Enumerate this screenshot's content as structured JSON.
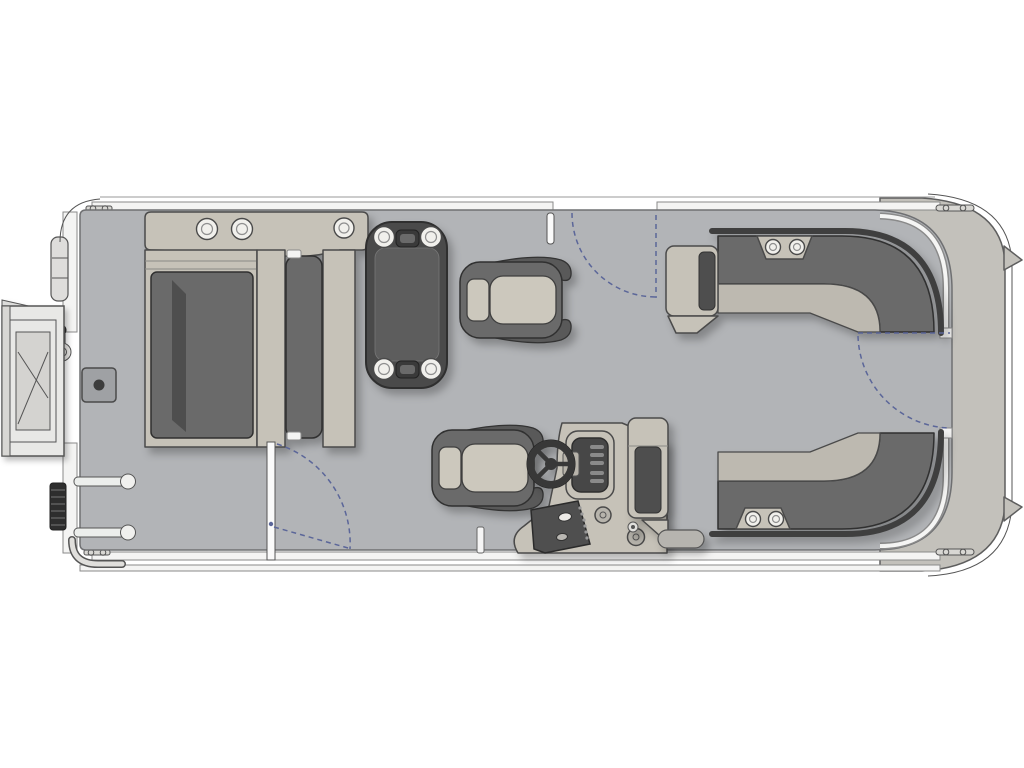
{
  "meta": {
    "title": "Pontoon boat floor plan, top-down view",
    "view": "top-down",
    "orientation": "bow on right, swim deck and boarding gate on left"
  },
  "colors": {
    "background": "#ffffff",
    "deck": "#b2b4b7",
    "hull_band": "#c3c1bb",
    "trim_white": "#f4f4f3",
    "trim_edge": "#8a8a8a",
    "outline": "#4a4a4a",
    "outline_dark": "#303030",
    "furniture_base": "#c6c2b8",
    "bench_seat": "#bdb9b0",
    "cushion": "#6a6a6a",
    "cushion_dark": "#4e4e4e",
    "cushion_darker": "#3f3f3f",
    "seat_light": "#ccc8bd",
    "panel_dark": "#474747",
    "cup_white": "#f1f0ec",
    "hatch": "#9fa1a4",
    "ladder_dark": "#2e2e2e",
    "gate_white": "#fafafa",
    "swing": "#5b6699",
    "shadow": "rgba(0,0,0,0.25)"
  },
  "components": {
    "hull": "pontoon hull with rub rails, cleats and bow platform",
    "port_boarding_gate": "boarding gate shown swung open with step platform",
    "stern_ladder": "folded boarding ladder with grab rails",
    "access_hatch": "square deck access hatch",
    "bow_lounger": "L-shaped chaise lounge with cupholder console",
    "dinette_table": "rectangular table with four cupholders",
    "captain_chair": "wrap-around swivel chair (forward)",
    "helm_chair": "wrap-around swivel chair at helm",
    "helm_console": "steering console with wheel, gauge panel and switch panel",
    "bench_top": "L-shaped corner bench with armrest and two cupholders",
    "bench_bottom": "L-shaped corner bench with armrest and two cupholders",
    "gate_swings": "dashed arcs showing gate swing paths (3 gates)"
  },
  "counts": {
    "swivel_chairs": 2,
    "table_cupholders": 4,
    "lounger_cupholders": 3,
    "bench_top_cupholders": 2,
    "bench_bottom_cupholders": 2,
    "gate_swing_arcs": 3,
    "cleats": 4
  }
}
